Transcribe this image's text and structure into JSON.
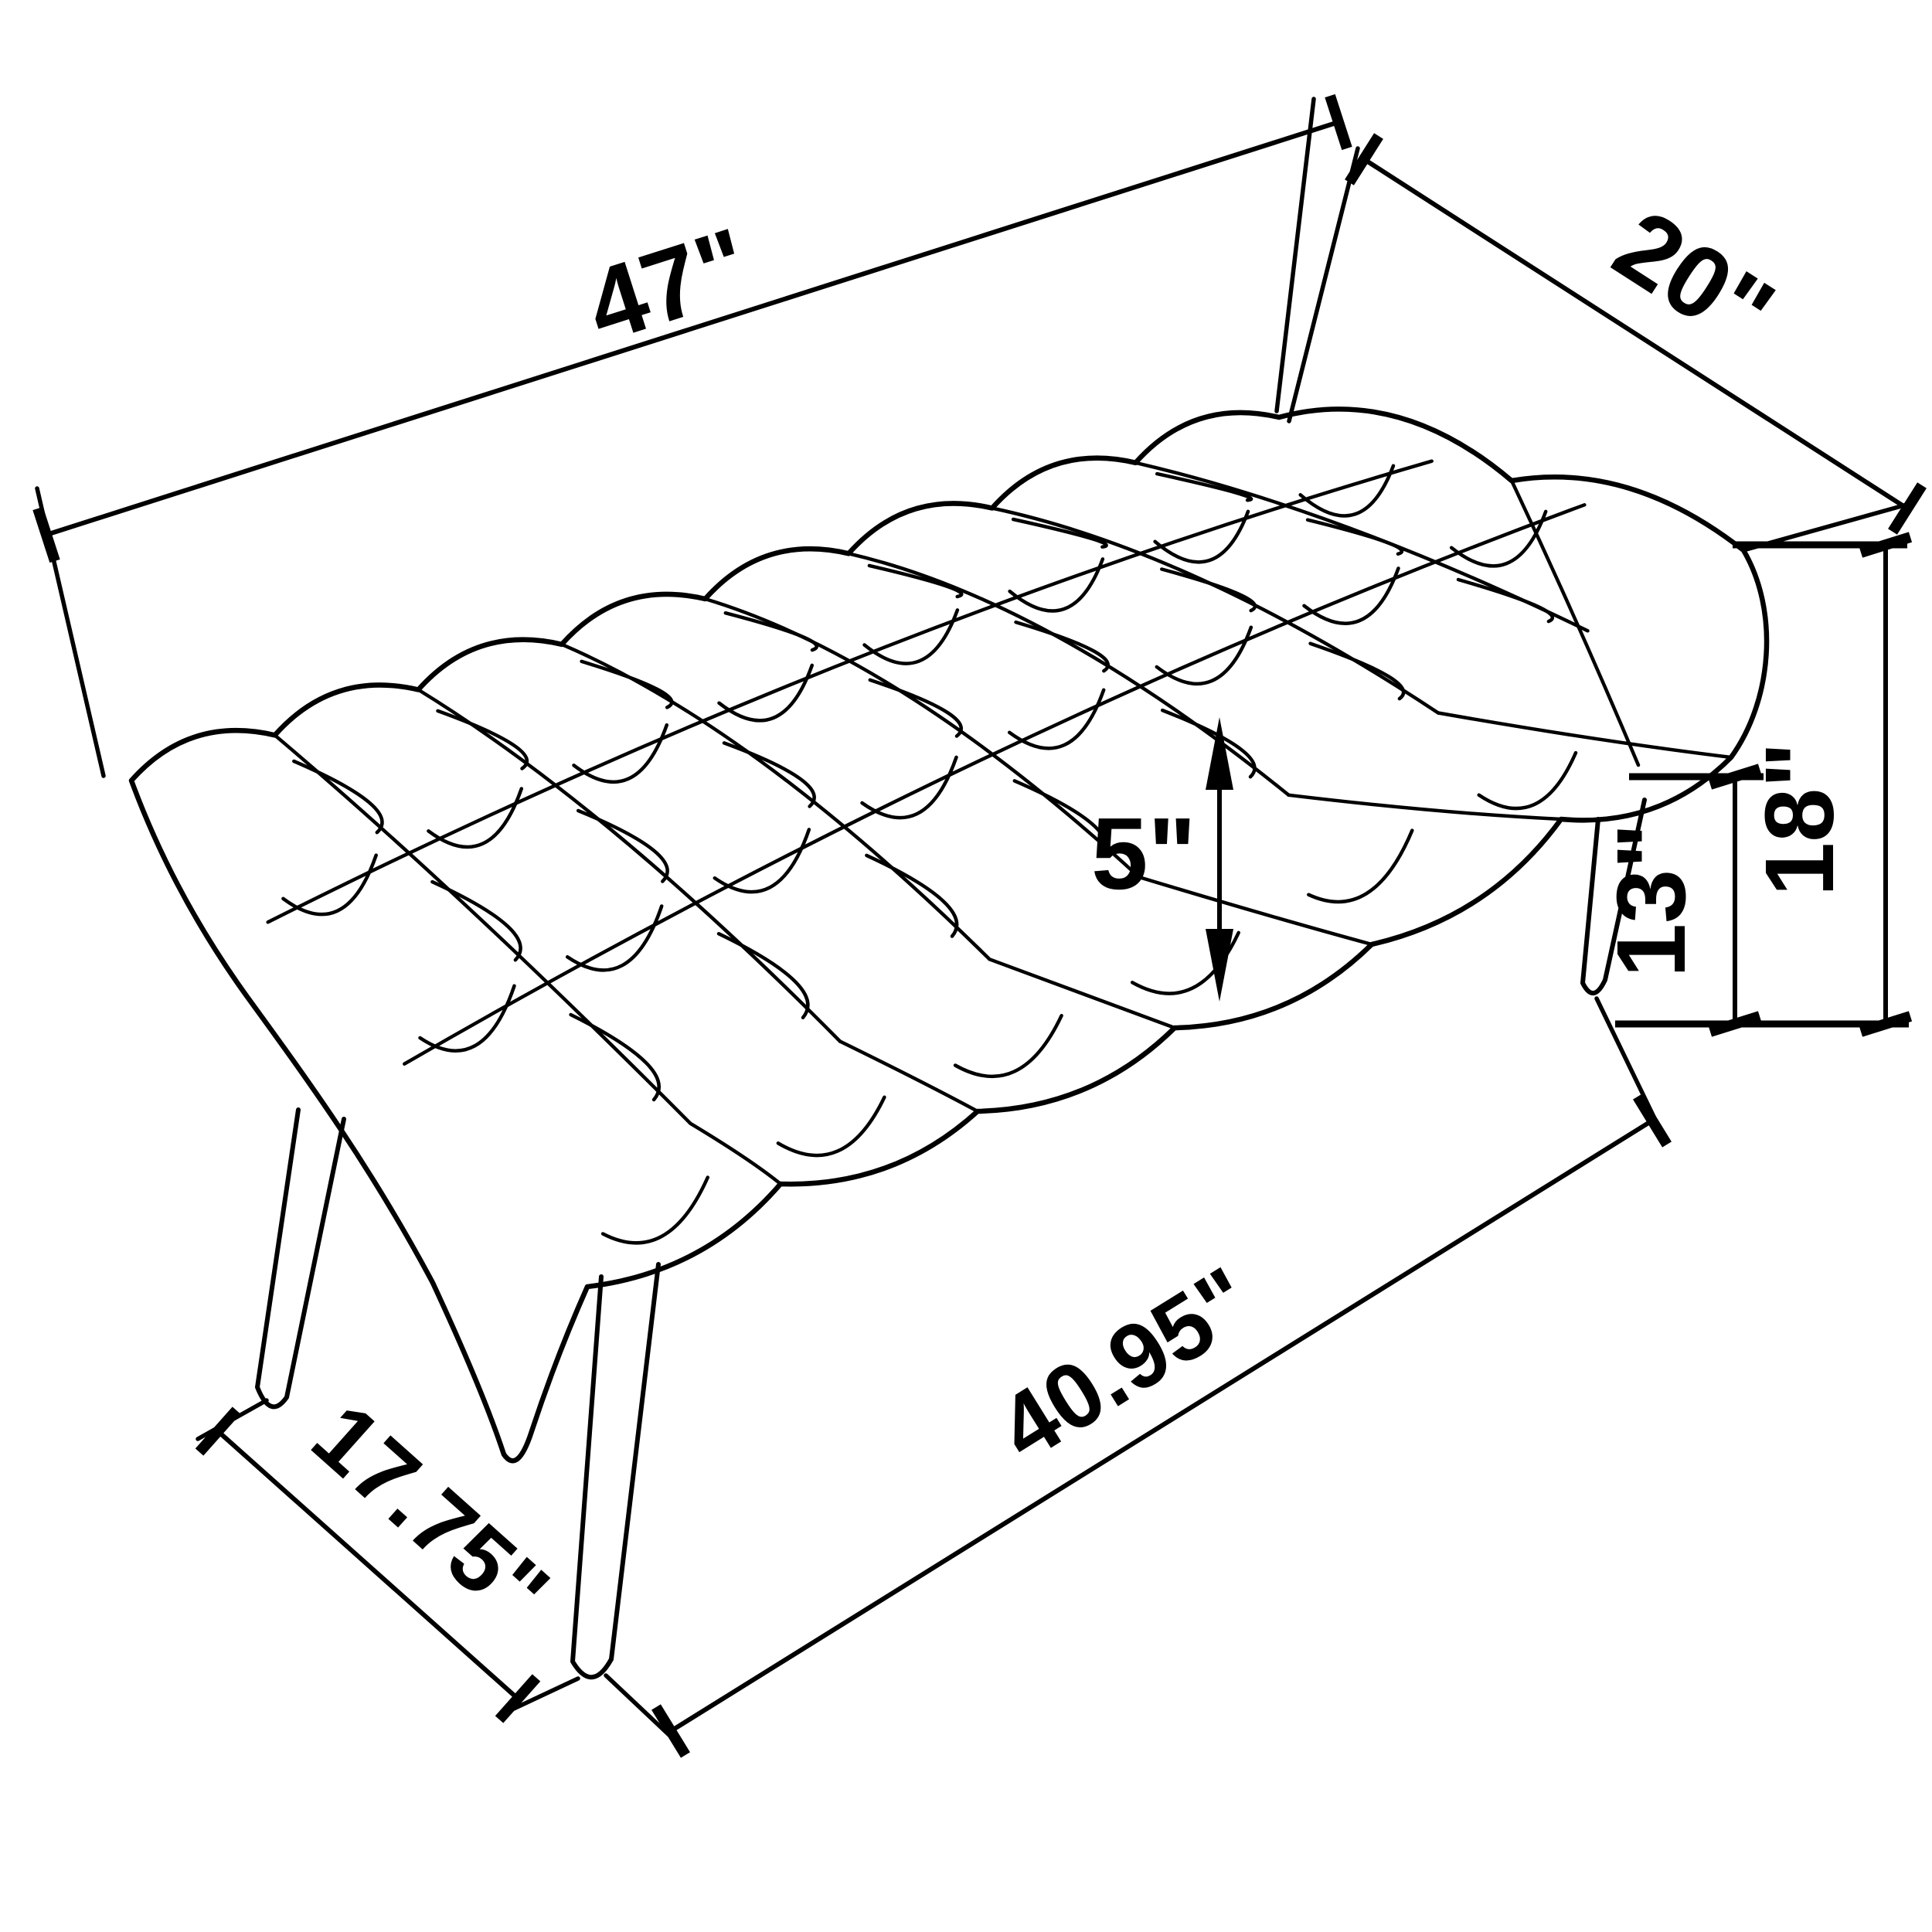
{
  "diagram": {
    "type": "furniture-dimension-drawing",
    "subject": "button-tufted bench with splayed tapered legs, three-quarter perspective line drawing",
    "background_color": "#ffffff",
    "line_color": "#000000",
    "labels": {
      "length": "47\"",
      "depth": "20\"",
      "cushion_thickness": "5\"",
      "overall_height": "18\"",
      "leg_height": "13\"",
      "footprint_depth": "17.75\"",
      "footprint_length": "40.95\""
    }
  }
}
